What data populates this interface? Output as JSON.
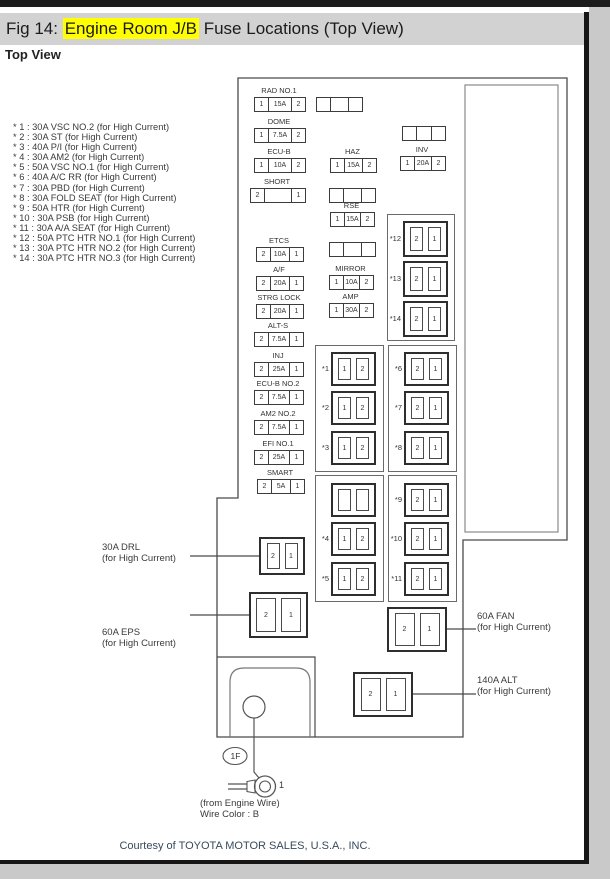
{
  "page": {
    "title_prefix": "Fig 14: ",
    "title_highlight": "Engine Room J/B",
    "title_suffix": " Fuse Locations (Top View)",
    "subtitle": "Top View",
    "courtesy": "Courtesy of TOYOTA MOTOR SALES, U.S.A., INC.",
    "highlight_color": "#ffff00",
    "titlebar_bg": "#d2d2d2"
  },
  "notes": [
    "* 1 : 30A VSC NO.2 (for High Current)",
    "* 2 : 30A ST (for High Current)",
    "* 3 : 40A P/I (for High Current)",
    "* 4 : 30A AM2 (for High Current)",
    "* 5 : 50A VSC NO.1 (for High Current)",
    "* 6 : 40A A/C RR (for High Current)",
    "* 7 : 30A PBD (for High Current)",
    "* 8 : 30A FOLD SEAT (for High Current)",
    "* 9 : 50A HTR (for High Current)",
    "* 10 : 30A PSB (for High Current)",
    "* 11 : 30A A/A SEAT (for High Current)",
    "* 12 : 50A PTC HTR NO.1 (for High Current)",
    "* 13 : 30A PTC HTR NO.2 (for High Current)",
    "* 14 : 30A PTC HTR NO.3 (for High Current)"
  ],
  "diagram": {
    "small_fuses": [
      {
        "label": "RAD NO.1",
        "cells": [
          "1",
          "15A",
          "2"
        ],
        "x": 254,
        "y": 97,
        "w": 50
      },
      {
        "label": "DOME",
        "cells": [
          "1",
          "7.5A",
          "2"
        ],
        "x": 254,
        "y": 128,
        "w": 50
      },
      {
        "label": "ECU-B",
        "cells": [
          "1",
          "10A",
          "2"
        ],
        "x": 254,
        "y": 158,
        "w": 50
      },
      {
        "label": "SHORT",
        "cells": [
          "2",
          "",
          "1"
        ],
        "x": 250,
        "y": 188,
        "w": 54
      },
      {
        "label": "ETCS",
        "cells": [
          "2",
          "10A",
          "1"
        ],
        "x": 256,
        "y": 247,
        "w": 46
      },
      {
        "label": "A/F",
        "cells": [
          "2",
          "20A",
          "1"
        ],
        "x": 256,
        "y": 276,
        "w": 46
      },
      {
        "label": "STRG LOCK",
        "cells": [
          "2",
          "20A",
          "1"
        ],
        "x": 256,
        "y": 304,
        "w": 46
      },
      {
        "label": "ALT-S",
        "cells": [
          "2",
          "7.5A",
          "1"
        ],
        "x": 254,
        "y": 332,
        "w": 48
      },
      {
        "label": "INJ",
        "cells": [
          "2",
          "25A",
          "1"
        ],
        "x": 254,
        "y": 362,
        "w": 48
      },
      {
        "label": "ECU-B NO.2",
        "cells": [
          "2",
          "7.5A",
          "1"
        ],
        "x": 254,
        "y": 390,
        "w": 48
      },
      {
        "label": "AM2 NO.2",
        "cells": [
          "2",
          "7.5A",
          "1"
        ],
        "x": 254,
        "y": 420,
        "w": 48
      },
      {
        "label": "EFI NO.1",
        "cells": [
          "2",
          "25A",
          "1"
        ],
        "x": 254,
        "y": 450,
        "w": 48
      },
      {
        "label": "SMART",
        "cells": [
          "2",
          "5A",
          "1"
        ],
        "x": 257,
        "y": 479,
        "w": 46
      },
      {
        "label": "",
        "cells": [
          "",
          "",
          ""
        ],
        "x": 316,
        "y": 97,
        "w": 45
      },
      {
        "label": "HAZ",
        "cells": [
          "1",
          "15A",
          "2"
        ],
        "x": 330,
        "y": 158,
        "w": 45
      },
      {
        "label": "",
        "cells": [
          "",
          "",
          ""
        ],
        "x": 329,
        "y": 188,
        "w": 45
      },
      {
        "label": "RSE",
        "cells": [
          "1",
          "15A",
          "2"
        ],
        "x": 330,
        "y": 212,
        "w": 43
      },
      {
        "label": "",
        "cells": [
          "",
          "",
          ""
        ],
        "x": 329,
        "y": 242,
        "w": 45
      },
      {
        "label": "MIRROR",
        "cells": [
          "1",
          "10A",
          "2"
        ],
        "x": 329,
        "y": 275,
        "w": 43
      },
      {
        "label": "AMP",
        "cells": [
          "1",
          "30A",
          "2"
        ],
        "x": 329,
        "y": 303,
        "w": 43
      },
      {
        "label": "",
        "cells": [
          "",
          "",
          ""
        ],
        "x": 402,
        "y": 126,
        "w": 42
      },
      {
        "label": "INV",
        "cells": [
          "1",
          "20A",
          "2"
        ],
        "x": 400,
        "y": 156,
        "w": 44
      }
    ],
    "hc_groups": [
      {
        "x": 387,
        "y": 214,
        "w": 66,
        "h": 125
      },
      {
        "x": 315,
        "y": 345,
        "w": 67,
        "h": 125
      },
      {
        "x": 388,
        "y": 345,
        "w": 67,
        "h": 125
      },
      {
        "x": 315,
        "y": 475,
        "w": 67,
        "h": 125
      },
      {
        "x": 388,
        "y": 475,
        "w": 67,
        "h": 125
      }
    ],
    "hc_fuses": [
      {
        "name": "fuse-ref-12",
        "label": "*12",
        "cells": [
          "2",
          "1"
        ],
        "x": 403,
        "y": 221,
        "w": 45,
        "h": 36
      },
      {
        "name": "fuse-ref-13",
        "label": "*13",
        "cells": [
          "2",
          "1"
        ],
        "x": 403,
        "y": 261,
        "w": 45,
        "h": 36
      },
      {
        "name": "fuse-ref-14",
        "label": "*14",
        "cells": [
          "2",
          "1"
        ],
        "x": 403,
        "y": 301,
        "w": 45,
        "h": 36
      },
      {
        "name": "fuse-ref-1",
        "label": "*1",
        "cells": [
          "1",
          "2"
        ],
        "x": 331,
        "y": 352,
        "w": 45,
        "h": 34
      },
      {
        "name": "fuse-ref-2",
        "label": "*2",
        "cells": [
          "1",
          "2"
        ],
        "x": 331,
        "y": 391,
        "w": 45,
        "h": 34
      },
      {
        "name": "fuse-ref-3",
        "label": "*3",
        "cells": [
          "1",
          "2"
        ],
        "x": 331,
        "y": 431,
        "w": 45,
        "h": 34
      },
      {
        "name": "fuse-ref-6",
        "label": "*6",
        "cells": [
          "2",
          "1"
        ],
        "x": 404,
        "y": 352,
        "w": 45,
        "h": 34
      },
      {
        "name": "fuse-ref-7",
        "label": "*7",
        "cells": [
          "2",
          "1"
        ],
        "x": 404,
        "y": 391,
        "w": 45,
        "h": 34
      },
      {
        "name": "fuse-ref-8",
        "label": "*8",
        "cells": [
          "2",
          "1"
        ],
        "x": 404,
        "y": 431,
        "w": 45,
        "h": 34
      },
      {
        "name": "fuse-blank-hc",
        "label": "",
        "cells": [
          "",
          ""
        ],
        "x": 331,
        "y": 483,
        "w": 45,
        "h": 34
      },
      {
        "name": "fuse-ref-4",
        "label": "*4",
        "cells": [
          "1",
          "2"
        ],
        "x": 331,
        "y": 522,
        "w": 45,
        "h": 34
      },
      {
        "name": "fuse-ref-5",
        "label": "*5",
        "cells": [
          "1",
          "2"
        ],
        "x": 331,
        "y": 562,
        "w": 45,
        "h": 34
      },
      {
        "name": "fuse-ref-9",
        "label": "*9",
        "cells": [
          "2",
          "1"
        ],
        "x": 404,
        "y": 483,
        "w": 45,
        "h": 34
      },
      {
        "name": "fuse-ref-10",
        "label": "*10",
        "cells": [
          "2",
          "1"
        ],
        "x": 404,
        "y": 522,
        "w": 45,
        "h": 34
      },
      {
        "name": "fuse-ref-11",
        "label": "*11",
        "cells": [
          "2",
          "1"
        ],
        "x": 404,
        "y": 562,
        "w": 45,
        "h": 34
      },
      {
        "name": "fuse-drl",
        "label": "",
        "cells": [
          "2",
          "1"
        ],
        "x": 259,
        "y": 537,
        "w": 46,
        "h": 38
      },
      {
        "name": "fuse-eps",
        "label": "",
        "cells": [
          "2",
          "1"
        ],
        "x": 249,
        "y": 592,
        "w": 59,
        "h": 46
      },
      {
        "name": "fuse-fan",
        "label": "",
        "cells": [
          "2",
          "1"
        ],
        "x": 387,
        "y": 607,
        "w": 60,
        "h": 45
      },
      {
        "name": "fuse-alt",
        "label": "",
        "cells": [
          "2",
          "1"
        ],
        "x": 353,
        "y": 672,
        "w": 60,
        "h": 45
      }
    ],
    "callouts": [
      {
        "name": "callout-drl",
        "line1": "30A DRL",
        "line2": "(for High Current)",
        "x": 102,
        "y": 543
      },
      {
        "name": "callout-eps",
        "line1": "60A EPS",
        "line2": "(for High Current)",
        "x": 102,
        "y": 628
      },
      {
        "name": "callout-fan",
        "line1": "60A FAN",
        "line2": "(for High Current)",
        "x": 477,
        "y": 612
      },
      {
        "name": "callout-alt",
        "line1": "140A ALT",
        "line2": "(for High Current)",
        "x": 477,
        "y": 676
      }
    ],
    "bottom": {
      "connector": "1F",
      "terminal_number": "1",
      "wire_note_1": "(from Engine Wire)",
      "wire_note_2": "Wire Color : B"
    }
  }
}
